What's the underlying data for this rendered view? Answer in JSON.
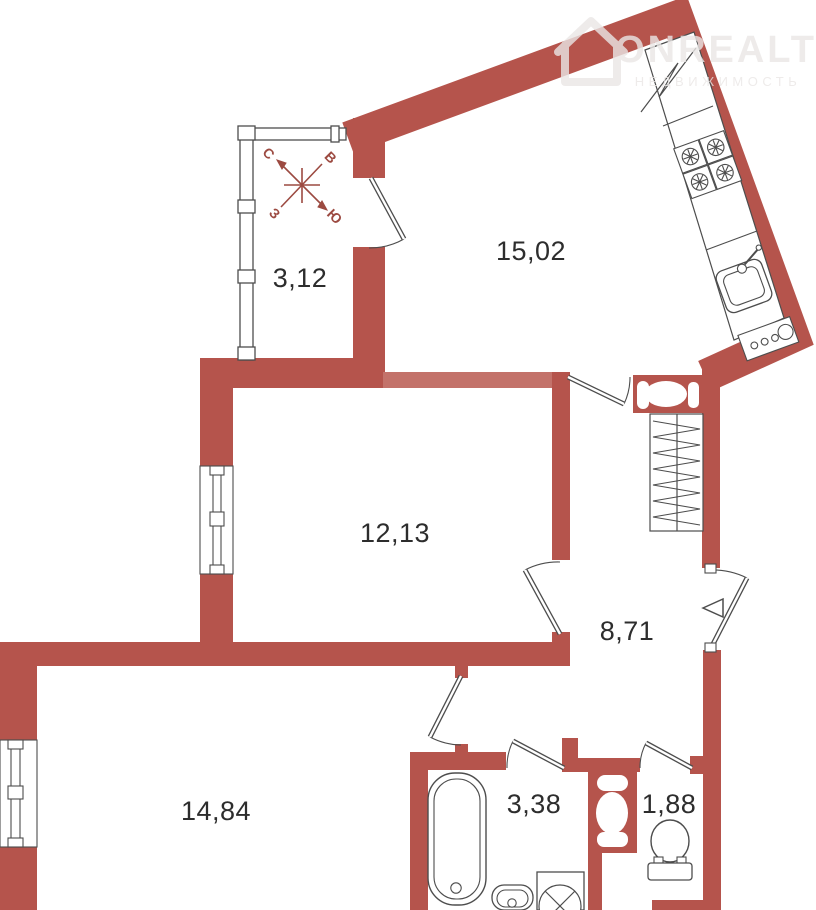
{
  "plan": {
    "rooms": [
      {
        "id": "balcony",
        "area": "3,12"
      },
      {
        "id": "kitchen",
        "area": "15,02"
      },
      {
        "id": "living-room",
        "area": "12,13"
      },
      {
        "id": "hallway",
        "area": "8,71"
      },
      {
        "id": "bedroom",
        "area": "14,84"
      },
      {
        "id": "bathroom",
        "area": "3,38"
      },
      {
        "id": "wc",
        "area": "1,88"
      }
    ],
    "compass": {
      "north": "С",
      "east": "В",
      "west": "З",
      "south": "Ю"
    },
    "fixtures": [
      "countertop",
      "break-line",
      "stove",
      "kitchen-sink",
      "vent-grille",
      "wardrobe-shelving",
      "ventilation-shaft",
      "entrance-arrow",
      "bathtub",
      "washbasin",
      "washing-machine",
      "toilet"
    ],
    "colors": {
      "wall": "#b5544c",
      "wall_light": "#c3726a",
      "outline": "#4d4d4d",
      "compass": "#9c4a41",
      "label_text": "#2d2d2d",
      "watermark": "#eae7e6",
      "background": "#ffffff"
    }
  },
  "watermark": {
    "brand": "ONREALT",
    "tagline": "НЕДВИЖИМОСТЬ"
  }
}
